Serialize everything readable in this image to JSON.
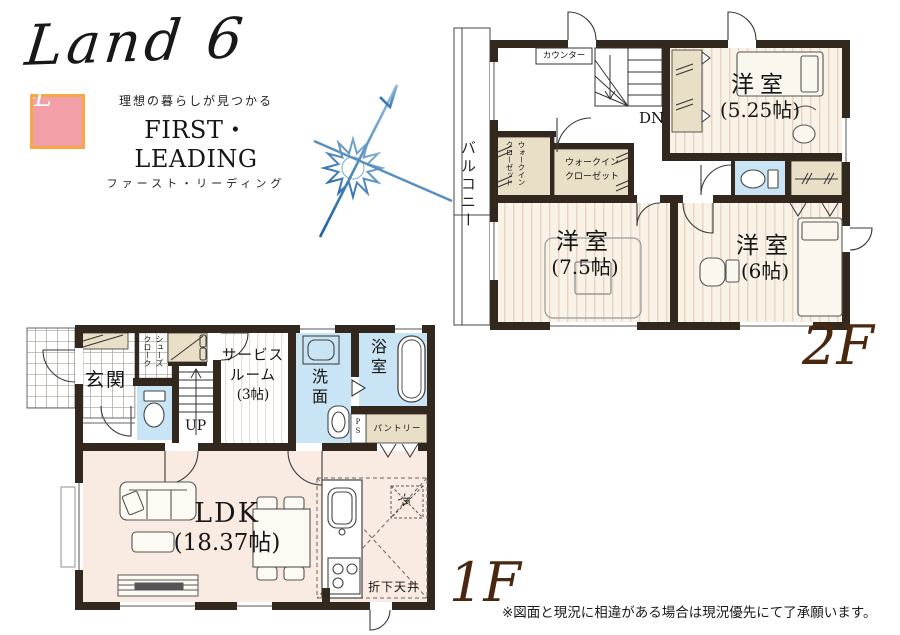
{
  "branding": {
    "product_name": "Land 6",
    "logo_monogram": "FL",
    "tagline": "理想の暮らしが見つかる",
    "company_en": "FIRST・LEADING",
    "company_jp": "ファースト・リーディング"
  },
  "floor2": {
    "floor_label": "2F",
    "balcony": "バルコニー",
    "counter": "カウンター",
    "stairs_down": "DN",
    "wic_vertical_col1": "ウォークイン",
    "wic_vertical_col2": "クローゼット",
    "wic_line1": "ウォークイン",
    "wic_line2": "クローゼット",
    "room525_name": "洋室",
    "room525_size": "(5.25帖)",
    "room75_name": "洋室",
    "room75_size": "(7.5帖)",
    "room6_name": "洋室",
    "room6_size": "(6帖)"
  },
  "floor1": {
    "floor_label": "1F",
    "entrance": "玄関",
    "shoe_closet_col1": "シューズ",
    "shoe_closet_col2": "クローク",
    "stairs_up": "UP",
    "service_line1": "サービス",
    "service_line2": "ルーム",
    "service_line3": "(3帖)",
    "washroom": "洗面",
    "bathroom": "浴室",
    "pipe_space": "PS",
    "pantry": "パントリー",
    "ldk_name": "LDK",
    "ldk_size": "(18.37帖)",
    "fridge": "冷",
    "lowered_ceiling": "折下天井"
  },
  "footer": {
    "disclaimer": "※図面と現況に相違がある場合は現況優先にて了承願います。"
  },
  "colors": {
    "wall": "#33281e",
    "wood_floor": "#f9f2e6",
    "wood_stripe": "#e9d4c4",
    "ldk_floor": "#f9ebe2",
    "closet_beige": "#e9dfc6",
    "water_blue": "#c9e4f4",
    "floor_label_brown": "#4a2810",
    "logo_pink": "#f29fa7",
    "logo_frame_orange": "#f5a944",
    "compass_blue": "#2a6cae"
  }
}
